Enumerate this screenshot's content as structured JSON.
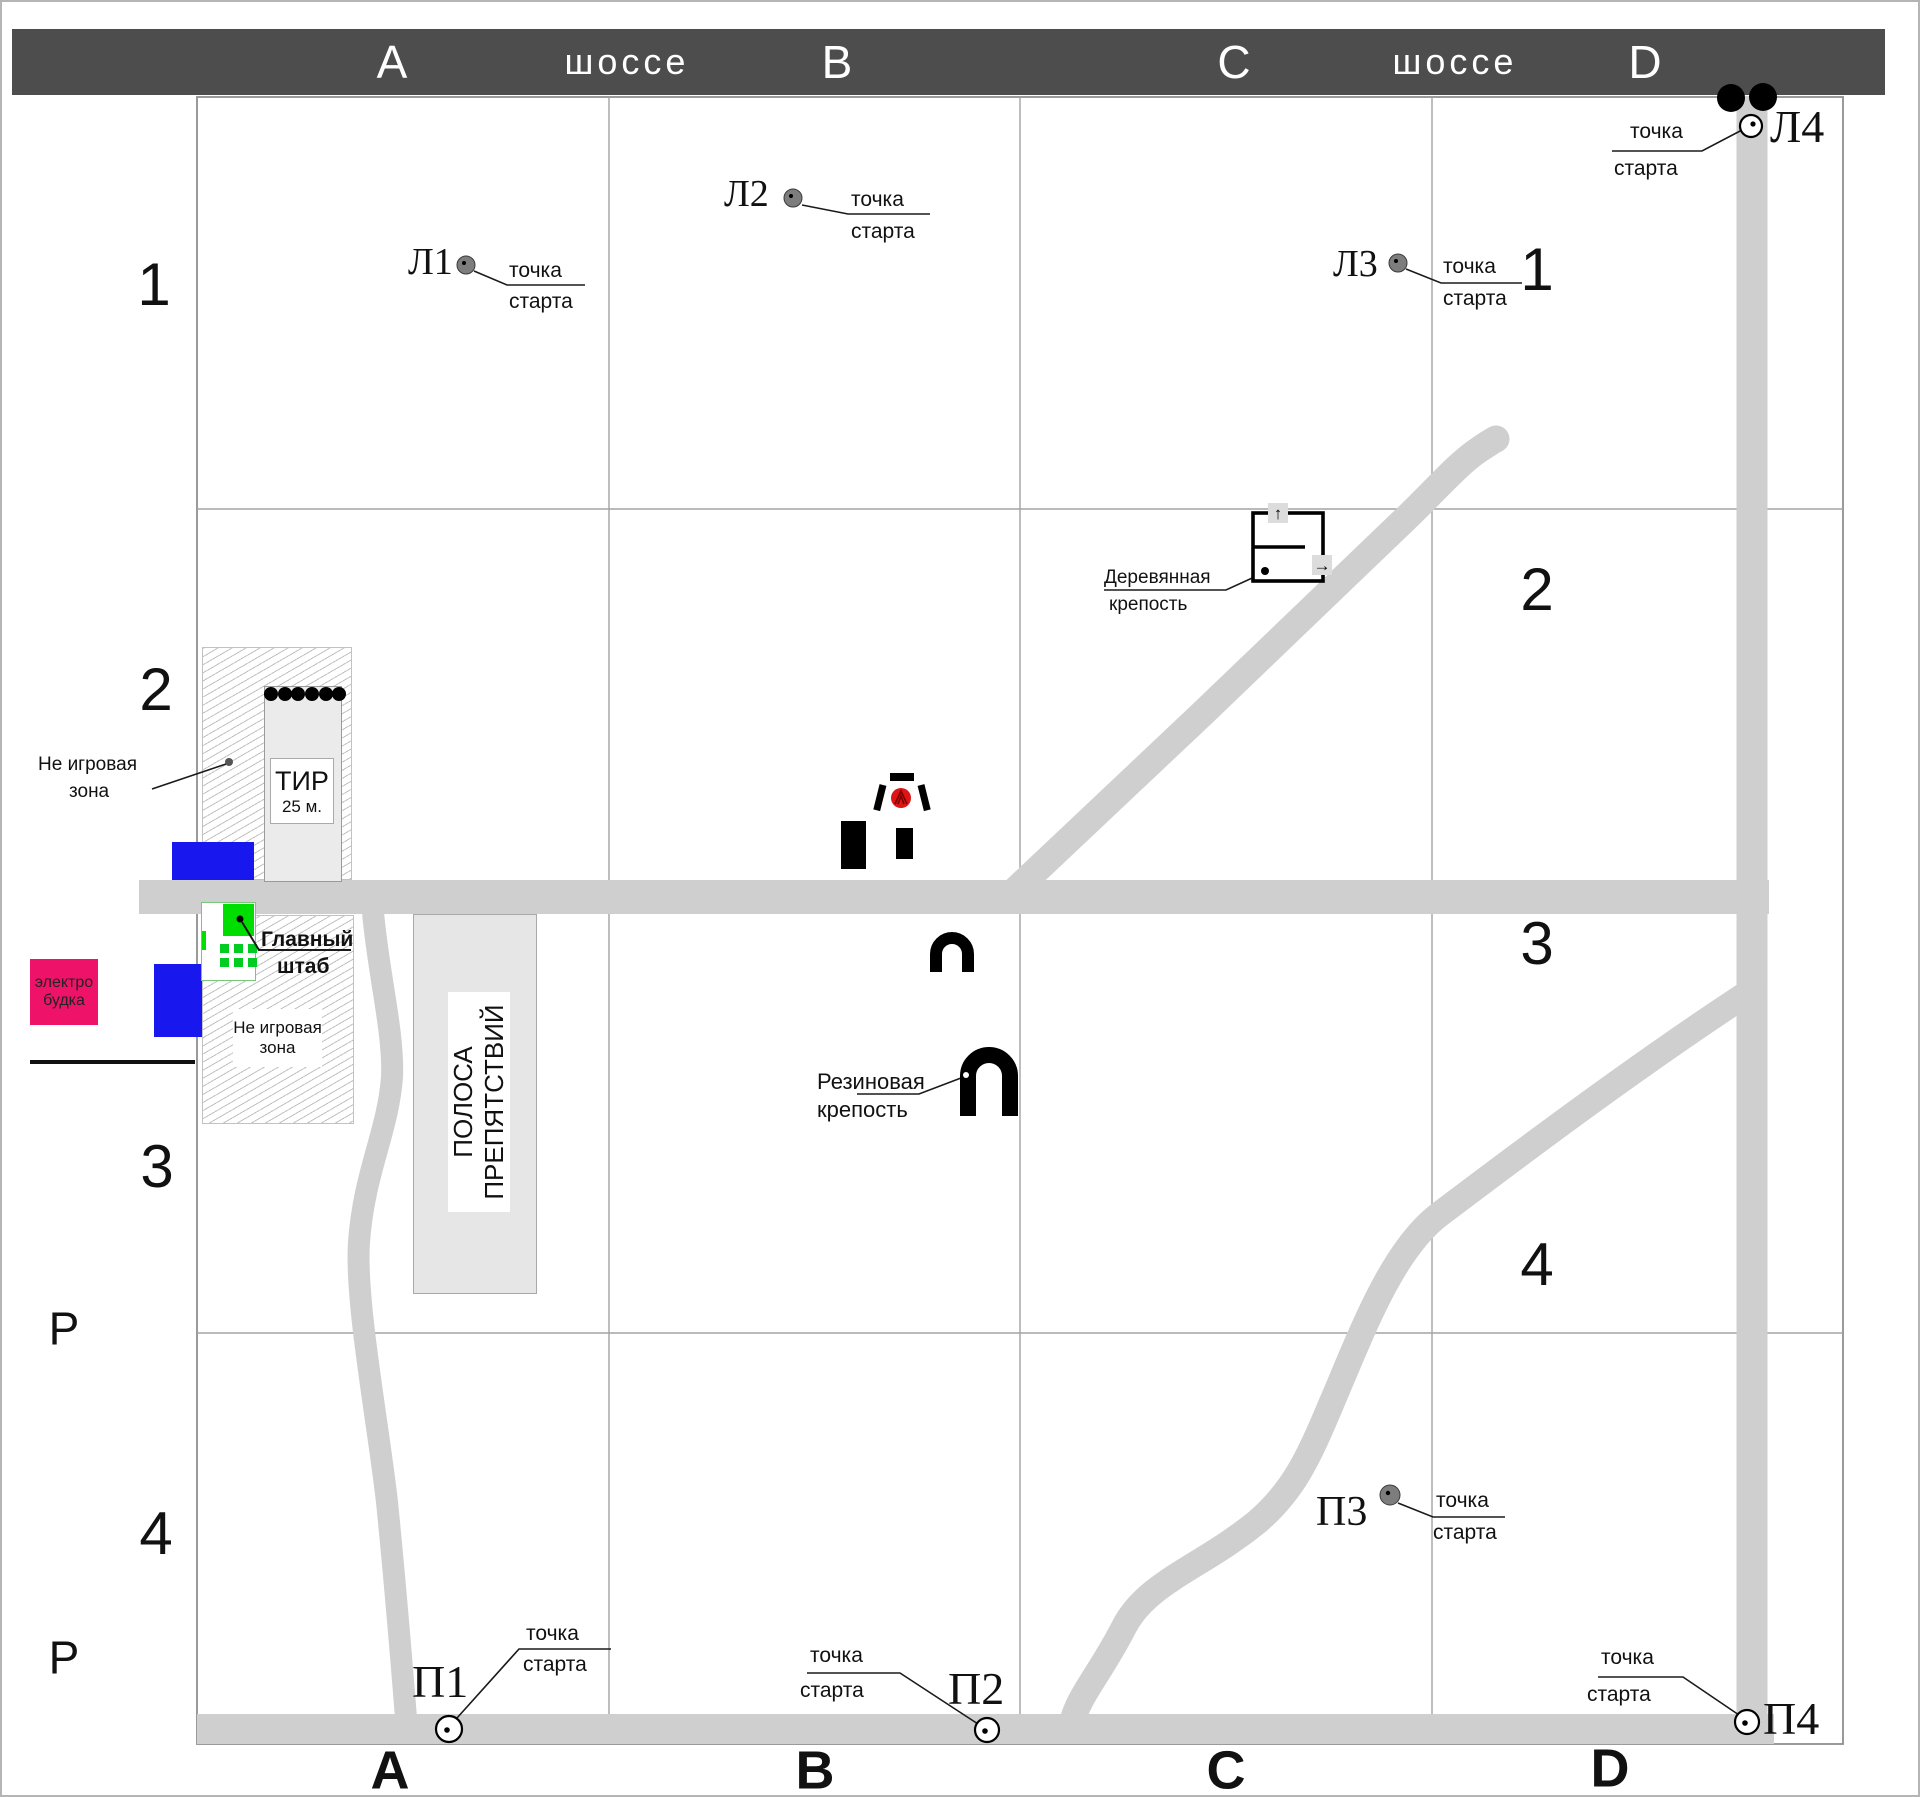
{
  "highway_bar": {
    "items": [
      "A",
      "шоссе",
      "B",
      "C",
      "шоссе",
      "D"
    ]
  },
  "row_labels_left": [
    "1",
    "2",
    "3",
    "Р",
    "4",
    "Р"
  ],
  "row_labels_right": [
    "1",
    "2",
    "3",
    "4"
  ],
  "column_labels_bottom": [
    "А",
    "В",
    "С",
    "D"
  ],
  "start_points": {
    "l1": {
      "name": "Л1",
      "line1": "точка",
      "line2": "старта"
    },
    "l2": {
      "name": "Л2",
      "line1": "точка",
      "line2": "старта"
    },
    "l3": {
      "name": "Л3",
      "line1": "точка",
      "line2": "старта"
    },
    "l4": {
      "name": "Л4",
      "line1": "точка",
      "line2": "старта"
    },
    "p1": {
      "name": "П1",
      "line1": "точка",
      "line2": "старта"
    },
    "p2": {
      "name": "П2",
      "line1": "точка",
      "line2": "старта"
    },
    "p3": {
      "name": "П3",
      "line1": "точка",
      "line2": "старта"
    },
    "p4": {
      "name": "П4",
      "line1": "точка",
      "line2": "старта"
    }
  },
  "places": {
    "tir": {
      "title": "ТИР",
      "subtitle": "25 м."
    },
    "hq": {
      "line1": "Главный",
      "line2": "штаб"
    },
    "nonplay_upper": {
      "line1": "Не игровая",
      "line2": "зона"
    },
    "nonplay_lower": {
      "line1": "Не игровая",
      "line2": "зона"
    },
    "obstacle": {
      "line1": "ПОЛОСА",
      "line2": "ПРЕПЯТСТВИЙ"
    },
    "electro": {
      "line1": "электро",
      "line2": "будка"
    },
    "wooden": {
      "line1": "Деревянная",
      "line2": "крепость"
    },
    "rubber": {
      "line1": "Резиновая",
      "line2": "крепость"
    }
  },
  "icons": {
    "up_arrow": "↑",
    "right_arrow": "→"
  },
  "colors": {
    "bar": "#4d4d4d",
    "road": "#cfcfcf",
    "grid_line": "#a3a3a3",
    "electro_pink": "#ee1368",
    "blue_building": "#1717ee",
    "hq_green": "#00dd00",
    "target_red": "#dd1515",
    "start_dot_gray": "#7d7d7d"
  }
}
